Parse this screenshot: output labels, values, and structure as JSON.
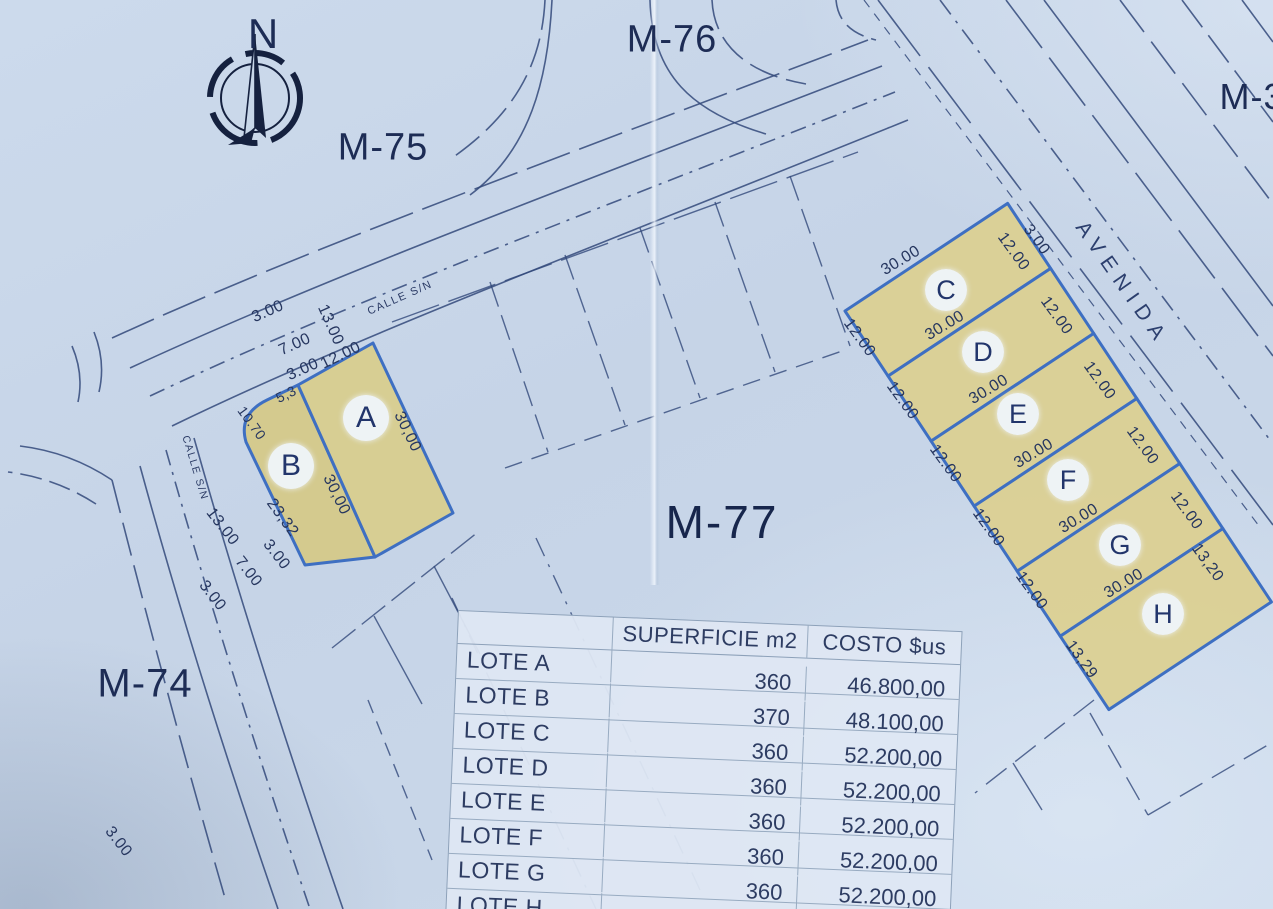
{
  "map": {
    "north_label": "N",
    "blocks": {
      "m74": "M-74",
      "m75": "M-75",
      "m76": "M-76",
      "m77": "M-77",
      "m3": "M-3"
    },
    "avenue_label": "AVENIDA",
    "streets": {
      "upper_name": "CALLE S/N",
      "left_name": "CALLE S/N"
    },
    "lot_letters": [
      "A",
      "B",
      "C",
      "D",
      "E",
      "F",
      "G",
      "H"
    ],
    "dims": {
      "upper_street": {
        "berm_n": "3.00",
        "road": "7.00",
        "width": "13.00",
        "berm_s": "3.00"
      },
      "left_street": {
        "width": "13.00",
        "road": "7.00",
        "berm_e": "3.00",
        "berm_w": "3.00",
        "berm_s": "3.00"
      },
      "lot_a": {
        "top": "12.00",
        "right": "30,00",
        "divider": "30,00"
      },
      "lot_b": {
        "top": "5,3",
        "corner": "10.70",
        "left": "23,32"
      },
      "strip": {
        "c": {
          "top": "30.00",
          "right": "12.00",
          "left": "12.00"
        },
        "d": {
          "top": "30.00",
          "right": "12.00",
          "left": "12.00"
        },
        "e": {
          "top": "30.00",
          "right": "12.00",
          "left": "12.00"
        },
        "f": {
          "top": "30.00",
          "right": "12.00",
          "left": "12.00"
        },
        "g": {
          "top": "30.00",
          "right": "12.00",
          "left": "12.00"
        },
        "h": {
          "top": "30.00",
          "right": "13,20",
          "bottom": "13,29"
        }
      },
      "avenue_berm": "3.00"
    }
  },
  "table": {
    "headers": {
      "superficie": "SUPERFICIE m2",
      "costo": "COSTO $us"
    },
    "rows": [
      {
        "label": "LOTE A",
        "superficie": "360",
        "costo": "46.800,00"
      },
      {
        "label": "LOTE B",
        "superficie": "370",
        "costo": "48.100,00"
      },
      {
        "label": "LOTE C",
        "superficie": "360",
        "costo": "52.200,00"
      },
      {
        "label": "LOTE D",
        "superficie": "360",
        "costo": "52.200,00"
      },
      {
        "label": "LOTE E",
        "superficie": "360",
        "costo": "52.200,00"
      },
      {
        "label": "LOTE F",
        "superficie": "360",
        "costo": "52.200,00"
      },
      {
        "label": "LOTE G",
        "superficie": "360",
        "costo": "52.200,00"
      },
      {
        "label": "LOTE H",
        "superficie": "360",
        "costo": ""
      }
    ]
  },
  "colors": {
    "paper": "#c7d6e8",
    "line": "#2e4470",
    "lot_fill": "#d8cd8e",
    "lot_border": "#3e6fc2",
    "text": "#1d2c55"
  }
}
